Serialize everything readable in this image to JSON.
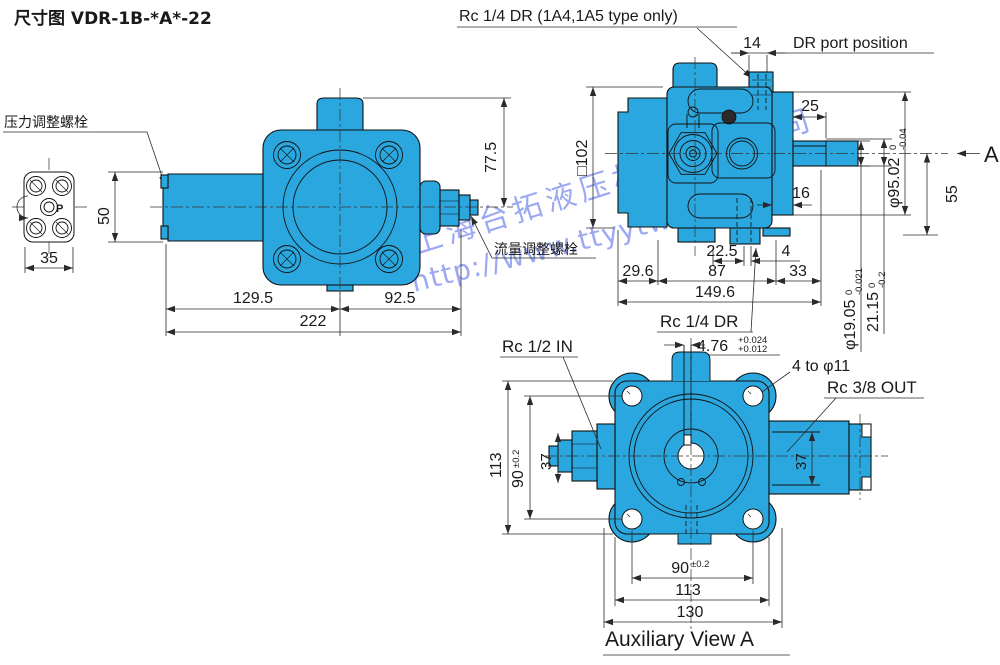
{
  "title": "尺寸图 VDR-1B-*A*-22",
  "colors": {
    "body": "#2BA7DF",
    "line": "#101010",
    "watermark": "#3B55E6"
  },
  "watermark": {
    "company": "上海台拓液压机械有限公司",
    "url": "http://www.ttyytw.com"
  },
  "labels": {
    "pressure_bolt": "压力调整螺栓",
    "flow_bolt": "流量调整螺栓",
    "dr_note": "Rc 1/4 DR (1A4,1A5 type only)",
    "dr_port_position": "DR port position",
    "rc14_dr": "Rc 1/4 DR",
    "rc12_in": "Rc 1/2 IN",
    "rc38_out": "Rc 3/8 OUT",
    "four_holes": "4 to φ11",
    "aux_view": "Auxiliary View A",
    "view_a": "A",
    "port_p": "P"
  },
  "top_view": {
    "d35": "35",
    "d50": "50",
    "d77_5": "77.5",
    "d129_5": "129.5",
    "d92_5": "92.5",
    "d222": "222"
  },
  "side_view": {
    "d14": "14",
    "dsq102": "□102",
    "d25": "25",
    "d16": "16",
    "d22_5": "22.5",
    "d4": "4",
    "d29_6": "29.6",
    "d87": "87",
    "d33": "33",
    "d149_6": "149.6",
    "d95": "φ95.02",
    "d95_tol_top": "0",
    "d95_tol_bot": "-0.04",
    "d55": "55",
    "d19": "φ19.05",
    "d19_tol_top": "0",
    "d19_tol_bot": "-0.021",
    "d21": "21.15",
    "d21_tol_top": "0",
    "d21_tol_bot": "-0.2",
    "d476": "4.76",
    "d476_tol_top": "+0.024",
    "d476_tol_bot": "+0.012"
  },
  "aux_view": {
    "d113_left": "113",
    "d90_left": "90",
    "d90_left_tol": "±0.2",
    "d37_in": "37",
    "d37_out": "37",
    "d90_bottom": "90",
    "d90_bottom_tol": "±0.2",
    "d113_bottom": "113",
    "d130": "130"
  }
}
